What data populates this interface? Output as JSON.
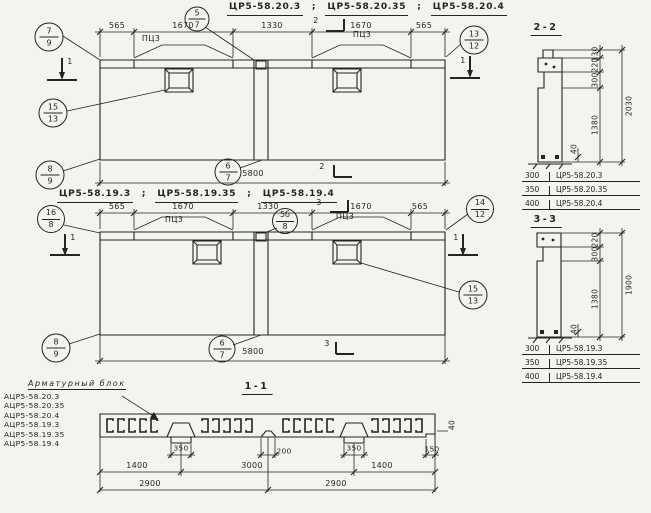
{
  "punct": {
    "semi": ";"
  },
  "d1": {
    "title": [
      "ЦР5-58.20.3",
      "ЦР5-58.20.35",
      "ЦР5-58.20.4"
    ],
    "dims_top": [
      "565",
      "1670",
      "1330",
      "1670",
      "565"
    ],
    "plate_left": "ПЦ3",
    "plate_right": "ПЦ3",
    "dim_bottom": "5800",
    "cut_vertical": "1",
    "cut_horizontal": "2",
    "balloons": {
      "tl": {
        "top": "7",
        "bot": "9"
      },
      "tc": {
        "top": "5",
        "bot": "7"
      },
      "tr": {
        "top": "13",
        "bot": "12"
      },
      "ml": {
        "top": "15",
        "bot": "13"
      },
      "bl": {
        "top": "8",
        "bot": "9"
      },
      "bc": {
        "top": "6",
        "bot": "7"
      }
    }
  },
  "d2": {
    "title": [
      "ЦР5-58.19.3",
      "ЦР5-58.19.35",
      "ЦР5-58.19.4"
    ],
    "dims_top": [
      "565",
      "1670",
      "1330",
      "1670",
      "565"
    ],
    "plate_left": "ПЦ3",
    "plate_right": "ПЦ3",
    "dim_bottom": "5800",
    "cut_vertical": "1",
    "cut_horizontal": "3",
    "balloons": {
      "tl": {
        "top": "16",
        "bot": "8"
      },
      "tc": {
        "top": "5б",
        "bot": "8"
      },
      "tr": {
        "top": "14",
        "bot": "12"
      },
      "mr": {
        "top": "15",
        "bot": "13"
      },
      "bl": {
        "top": "8",
        "bot": "9"
      },
      "bc": {
        "top": "6",
        "bot": "7"
      }
    }
  },
  "s22": {
    "label": "2-2",
    "dims": [
      "130",
      "220",
      "300",
      "1380"
    ],
    "dim_small": "40",
    "dim_total": "2030",
    "table": [
      {
        "t": "300",
        "name": "ЦР5-58.20.3"
      },
      {
        "t": "350",
        "name": "ЦР5-58.20.35"
      },
      {
        "t": "400",
        "name": "ЦР5-58.20.4"
      }
    ]
  },
  "s33": {
    "label": "3-3",
    "dims": [
      "220",
      "300",
      "1380"
    ],
    "dim_small": "40",
    "dim_total": "1900",
    "table": [
      {
        "t": "300",
        "name": "ЦР5-58.19.3"
      },
      {
        "t": "350",
        "name": "ЦР5-58.19.35"
      },
      {
        "t": "400",
        "name": "ЦР5-58.19.4"
      }
    ]
  },
  "s11": {
    "label": "1-1",
    "legend_title": "Арматурный блок",
    "legend_items": [
      "АЦР5-58.20.3",
      "АЦР5-58.20.35",
      "АЦР5-58.20.4",
      "АЦР5-58.19.3",
      "АЦР5-58.19.35",
      "АЦР5-58.19.4"
    ],
    "dims_row1": [
      "350",
      "200",
      "350",
      "150"
    ],
    "dims_row2": [
      "1400",
      "3000",
      "1400"
    ],
    "dims_row3": [
      "2900",
      "2900"
    ],
    "dim_end": "40"
  }
}
